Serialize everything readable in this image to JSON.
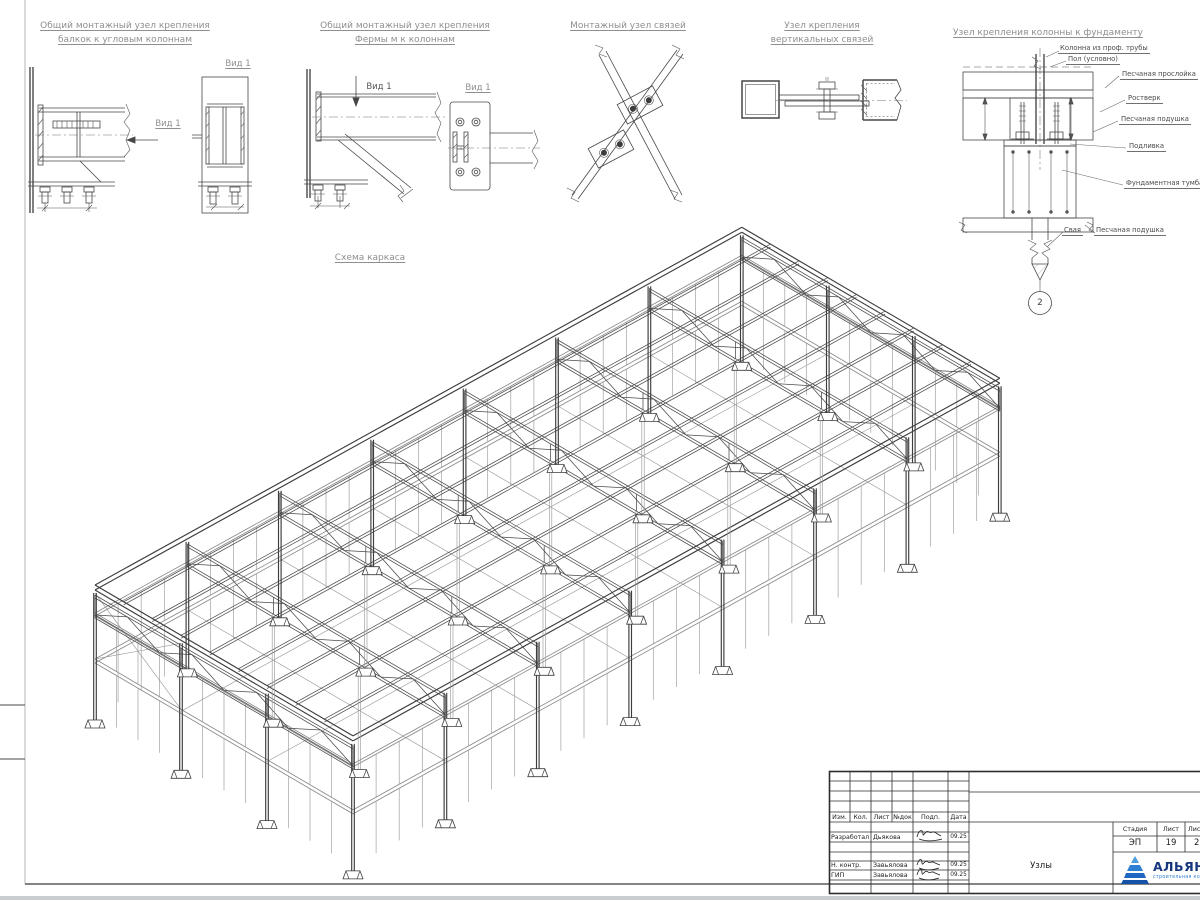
{
  "sheet": {
    "background": "#ffffff",
    "line_color": "#474747",
    "light_line_color": "#9b9b9b",
    "label_color": "#8f8f8f",
    "accent_blue": "#2d7fd3"
  },
  "details": [
    {
      "id": "corner-column-beam",
      "title_lines": [
        "Общий монтажный узел крепления",
        "балкок к угловым колоннам"
      ],
      "view_label": "Вид 1",
      "view_label_2": "Вид 1"
    },
    {
      "id": "truss-to-column",
      "title_lines": [
        "Общий монтажный узел крепления",
        "Фермы м к колоннам"
      ],
      "view_label": "Вид 1",
      "view_label_2": "Вид 1"
    },
    {
      "id": "braces-node",
      "title_lines": [
        "Монтажный узел связей"
      ]
    },
    {
      "id": "vertical-braces",
      "title_lines": [
        "Узел крепления",
        "вертикальных связей"
      ]
    },
    {
      "id": "column-to-foundation",
      "title_lines": [
        "Узел крепления колонны к фундаменту"
      ],
      "annotations": [
        "Колонна из проф. трубы",
        "Пол (условно)",
        "Песчаная прослойка",
        "Ростверк",
        "Песчаная подушка",
        "Подливка",
        "Фундаментная тумба",
        "Свая",
        "Песчаная подушка"
      ],
      "marker": "2"
    }
  ],
  "scheme": {
    "title": "Схема каркаса",
    "iso": {
      "origin": [
        95,
        585
      ],
      "u": [
        92.4,
        -51.1
      ],
      "w": [
        86,
        50.3
      ],
      "bays_u": 7,
      "bays_w": 3,
      "purlin_lines": 10,
      "truss_top_z": 10,
      "truss_bottom_z": 30,
      "girt_z": 28,
      "floor_z": 74,
      "base_z": 137,
      "stud_end_z": 130
    }
  },
  "title_block": {
    "columns": [
      "Изм.",
      "Кол.",
      "Лист",
      "№док",
      "Подп.",
      "Дата"
    ],
    "rows": [
      {
        "role": "Разработал",
        "name": "Дьякова",
        "date": "09.25"
      },
      {
        "role": "Н. контр.",
        "name": "Завьялова",
        "date": "09.25"
      },
      {
        "role": "ГИП",
        "name": "Завьялова",
        "date": "09.25"
      }
    ],
    "stage_label": "Стадия",
    "sheet_label": "Лист",
    "sheets_label": "Листов",
    "stage": "ЭП",
    "sheet": "19",
    "sheets": "2",
    "doc_title": "Узлы",
    "logo": {
      "name": "АЛЬЯНС",
      "subtitle": "строительная компания",
      "accent": "#2d7fd3",
      "text_color": "#16367f"
    }
  }
}
